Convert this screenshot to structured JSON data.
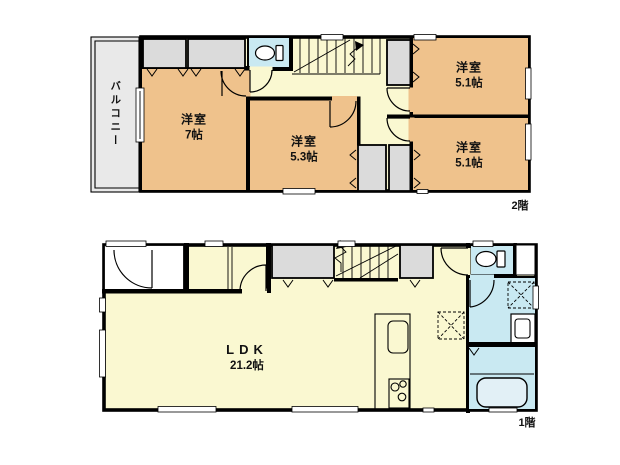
{
  "plan": {
    "floor2": {
      "floor_label": "2階",
      "balcony_label": "バルコニー",
      "rooms": {
        "room7": {
          "name": "洋室",
          "size": "7帖"
        },
        "room53": {
          "name": "洋室",
          "size": "5.3帖"
        },
        "room51a": {
          "name": "洋室",
          "size": "5.1帖"
        },
        "room51b": {
          "name": "洋室",
          "size": "5.1帖"
        }
      }
    },
    "floor1": {
      "floor_label": "1階",
      "rooms": {
        "ldk": {
          "name": "LDK",
          "size": "21.2帖"
        }
      }
    }
  },
  "colors": {
    "room": "#EFC28C",
    "hall": "#FAF8D1",
    "wet": "#C9E9F2",
    "closet": "#DBDBDB",
    "balcony": "#E9E9E9",
    "wall": "#000000",
    "bg": "#FFFFFF",
    "text": "#111111"
  }
}
